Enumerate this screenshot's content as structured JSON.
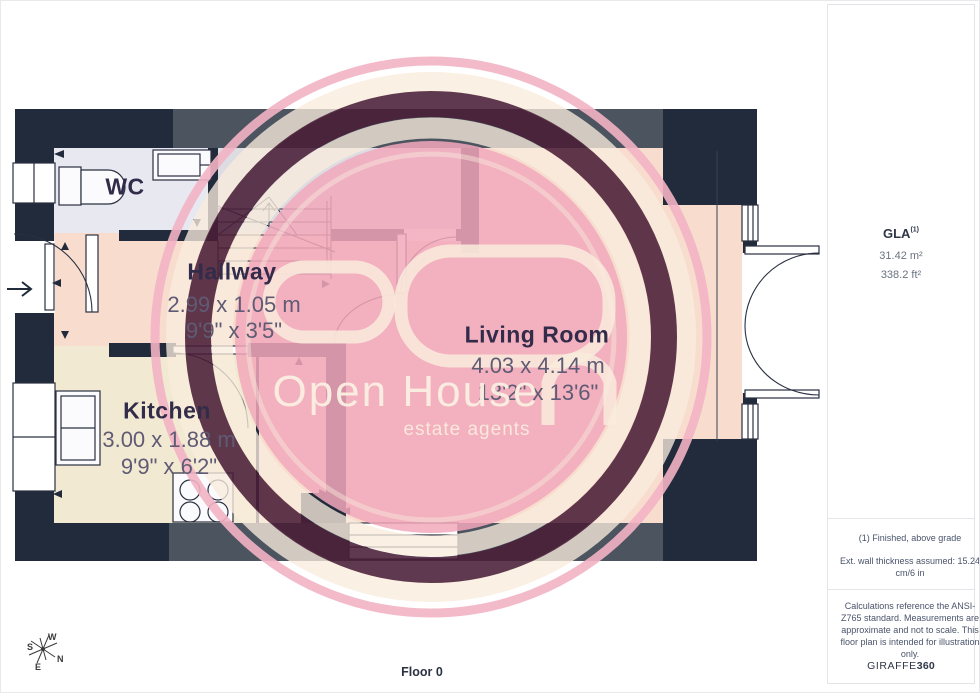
{
  "floorplan": {
    "floor_label": "Floor 0",
    "rooms": [
      {
        "name": "WC",
        "dim_metric": "",
        "dim_imperial": ""
      },
      {
        "name": "Hallway",
        "dim_metric": "2.99 x 1.05 m",
        "dim_imperial": "9'9\" x 3'5\""
      },
      {
        "name": "Kitchen",
        "dim_metric": "3.00 x 1.88 m",
        "dim_imperial": "9'9\" x 6'2\""
      },
      {
        "name": "Living Room",
        "dim_metric": "4.03 x 4.14 m",
        "dim_imperial": "13'2\" x 13'6\""
      }
    ]
  },
  "watermark": {
    "line1": "Open House",
    "line2": "estate agents"
  },
  "compass": {
    "n": "N",
    "s": "S",
    "e": "E",
    "w": "W"
  },
  "sidebar": {
    "gla_label": "GLA",
    "gla_superscript": "(1)",
    "gla_metric": "31.42 m²",
    "gla_imperial": "338.2 ft²",
    "note_finished": "(1) Finished, above grade",
    "note_wall": "Ext. wall thickness assumed: 15.24 cm/6 in",
    "note_calc": "Calculations reference the ANSI-Z765 standard. Measurements are approximate and not to scale. This floor plan is intended for illustration only.",
    "brand_name": "GIRAFFE",
    "brand_number": "360"
  },
  "colors": {
    "wall_dark": "#212b3b",
    "wall_gray": "#4b545f",
    "room_cream": "#f8ddcf",
    "room_beige": "#f2e9d2",
    "room_wc": "#e7e8f0",
    "room_landing": "#dcdce2",
    "watermark_pink": "#f0a4b8",
    "watermark_dark": "#491e37",
    "watermark_cream": "#f9ecdd"
  }
}
